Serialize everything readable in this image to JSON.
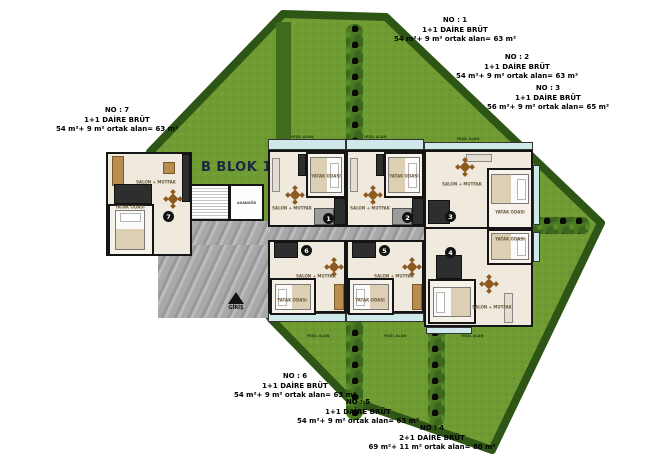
{
  "plan": {
    "title": "B BLOK 1.KAT",
    "entrance": "GİRİŞ",
    "elevator": "ASANSÖR"
  },
  "labels": {
    "salon": "SALON + MUTFAK",
    "bedroom": "YATAK ODASI",
    "green": "YEŞİL ALAN"
  },
  "annotations": [
    {
      "no": "NO : 1",
      "type": "1+1 DAİRE BRÜT",
      "area": "54 m²+ 9 m² ortak alan= 63 m²"
    },
    {
      "no": "NO : 2",
      "type": "1+1 DAİRE BRÜT",
      "area": "54 m²+ 9 m² ortak alan= 63 m²"
    },
    {
      "no": "NO : 3",
      "type": "1+1 DAİRE BRÜT",
      "area": "56 m²+ 9 m² ortak alan= 65 m²"
    },
    {
      "no": "NO : 4",
      "type": "2+1 DAİRE BRÜT",
      "area": "69 m²+ 11 m² ortak alan= 80 m²"
    },
    {
      "no": "NO : 5",
      "type": "1+1 DAİRE BRÜT",
      "area": "54 m²+ 9 m² ortak alan= 63 m²"
    },
    {
      "no": "NO : 6",
      "type": "1+1 DAİRE BRÜT",
      "area": "54 m²+ 9 m² ortak alan= 63 m²"
    },
    {
      "no": "NO : 7",
      "type": "1+1 DAİRE BRÜT",
      "area": "54 m²+ 9 m² ortak alan= 63 m²"
    }
  ],
  "units": [
    {
      "number": "1"
    },
    {
      "number": "2"
    },
    {
      "number": "3"
    },
    {
      "number": "4"
    },
    {
      "number": "5"
    },
    {
      "number": "6"
    },
    {
      "number": "7"
    }
  ],
  "colors": {
    "lawn": "#6f9b33",
    "lawn_border": "#2d5516",
    "hedge": "#3f6b1d",
    "balcony_glass": "#cfe8ea",
    "corridor": "#a9a9a9",
    "wall": "#151515",
    "title_text": "#1a2742"
  }
}
